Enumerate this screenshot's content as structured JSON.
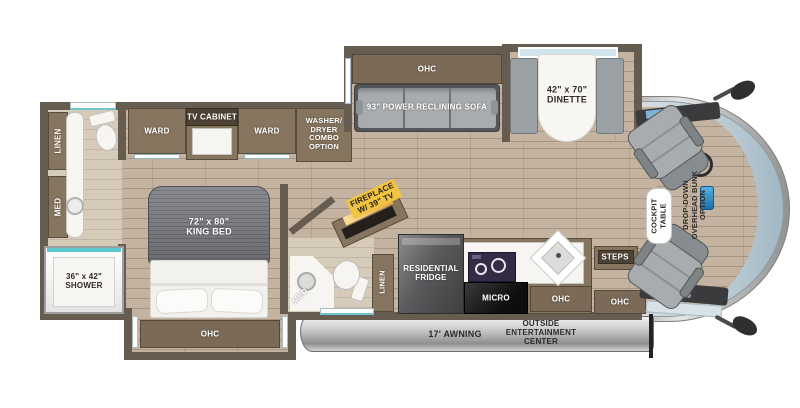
{
  "colors": {
    "wall": "#675C50",
    "cabinet_brown": "#86755F",
    "floor_wood": "#C3B3A0",
    "window_teal": "#5BC8D0",
    "fireplace_label_yellow": "#F0C342",
    "sofa_gray": "#A8ACAF",
    "windshield_blue": "#B5C7D1",
    "label_dark": "#2F2B27"
  },
  "labels": {
    "linen_rear": "LINEN",
    "med_rear": "MED",
    "shower": "36\" x 42\"\nSHOWER",
    "ward_left": "WARD",
    "tv_cabinet": "TV CABINET",
    "ward_right": "WARD",
    "washer_dryer": "WASHER/\nDRYER\nCOMBO\nOPTION",
    "king_bed": "72\" x 80\"\nKING BED",
    "bed_ohc": "OHC",
    "sofa_ohc": "OHC",
    "sofa": "93\" POWER RECLINING SOFA",
    "dinette": "42\" x 70\"\nDINETTE",
    "fireplace": "FIREPLACE\nW/ 39\" TV",
    "med_mid": "MED",
    "linen_mid": "LINEN",
    "fridge": "RESIDENTIAL\nFRIDGE",
    "micro": "MICRO",
    "kitchen_ohc": "OHC",
    "steps": "STEPS",
    "entry_ohc": "OHC",
    "cockpit_table": "COCKPIT\nTABLE",
    "overhead_bunk": "DROP-DOWN\nOVERHEAD BUNK\nOPTION",
    "awning": "17' AWNING",
    "outside_entertainment": "OUTSIDE\nENTERTAINMENT\nCENTER"
  }
}
